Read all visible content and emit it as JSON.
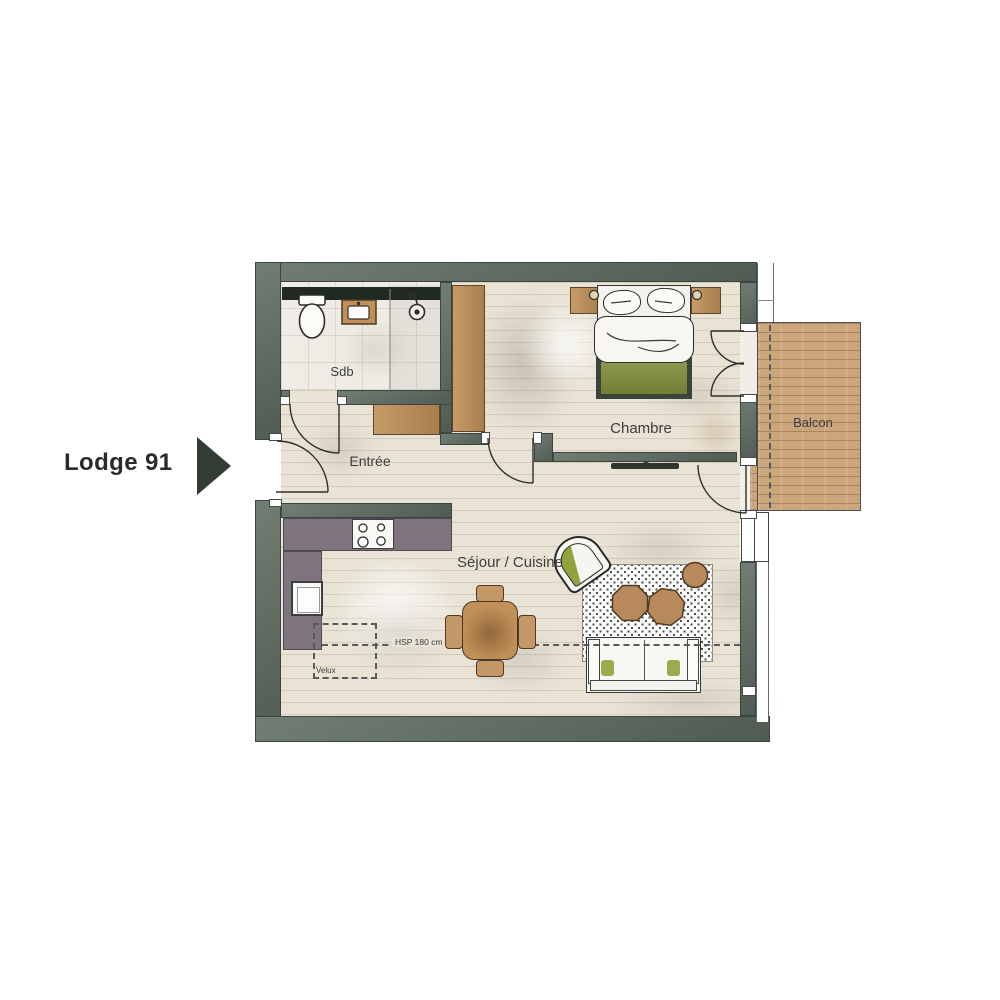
{
  "title": {
    "label": "Lodge 91",
    "arrow_icon": "right-triangle"
  },
  "rooms": {
    "bathroom": {
      "label": "Sdb"
    },
    "entry": {
      "label": "Entrée"
    },
    "bedroom": {
      "label": "Chambre"
    },
    "balcony": {
      "label": "Balcon"
    },
    "living_kitchen": {
      "label": "Séjour / Cuisine"
    }
  },
  "annotations": {
    "skylight": "Velux",
    "ceiling_height": "HSP 180 cm"
  },
  "furniture": [
    "toilet",
    "washbasin",
    "shower",
    "wardrobe",
    "entry-closet",
    "double-bed",
    "nightstand-left",
    "nightstand-right",
    "tv",
    "kitchen-counter",
    "cooktop",
    "kitchen-sink",
    "dining-table",
    "dining-chairs",
    "armchair",
    "sofa",
    "rug",
    "poufs",
    "balcony-deck"
  ],
  "colors": {
    "wall": "#5b685e",
    "wall_edge": "#3b463e",
    "duct": "#212a21",
    "floor": "#e9e3d6",
    "bath_floor": "#efece5",
    "counter": "#7e747d",
    "wood": "#c09058",
    "wood_edge": "#5e4527",
    "deck": "#cba57c",
    "bed_frame": "#3a443b",
    "green": "#7f8d3b",
    "green_light": "#93a13e",
    "ink": "#2d2d2d",
    "label": "#3d3d3d",
    "dash": "#5a5a5a"
  }
}
